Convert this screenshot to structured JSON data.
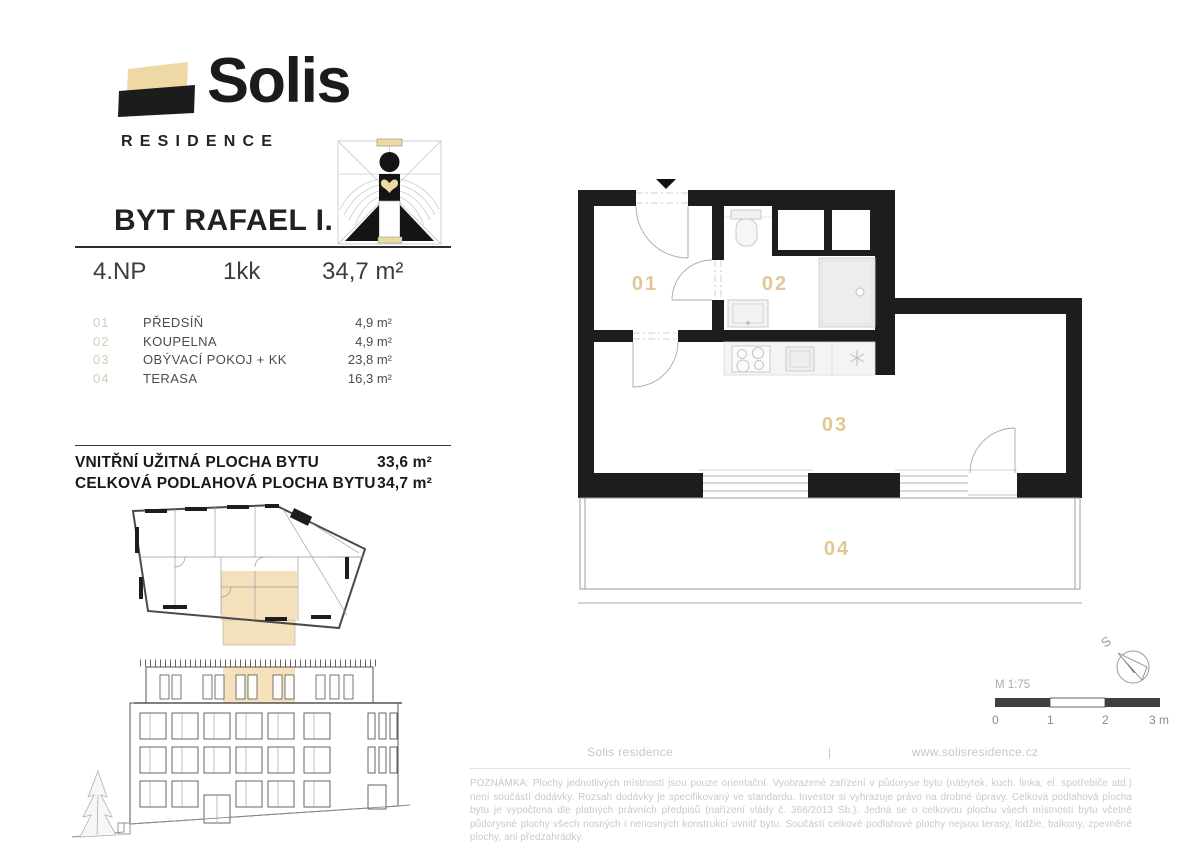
{
  "brand": {
    "name": "Solis",
    "subtitle": "RESIDENCE"
  },
  "unit": {
    "title": "BYT RAFAEL I.",
    "floor": "4.NP",
    "layout": "1kk",
    "area": "34,7 m²"
  },
  "rooms": [
    {
      "num": "01",
      "name": "PŘEDSÍŇ",
      "area": "4,9 m²"
    },
    {
      "num": "02",
      "name": "KOUPELNA",
      "area": "4,9 m²"
    },
    {
      "num": "03",
      "name": "OBÝVACÍ POKOJ + KK",
      "area": "23,8 m²"
    },
    {
      "num": "04",
      "name": "TERASA",
      "area": "16,3 m²"
    }
  ],
  "totals": [
    {
      "label": "VNITŘNÍ UŽITNÁ PLOCHA BYTU",
      "value": "33,6 m²"
    },
    {
      "label": "CELKOVÁ PODLAHOVÁ PLOCHA BYTU",
      "value": "34,7 m²"
    }
  ],
  "plan": {
    "labels": [
      "01",
      "02",
      "03",
      "04"
    ]
  },
  "scalebar": {
    "scale": "M 1:75",
    "ticks": [
      "0",
      "1",
      "2",
      "3 m"
    ],
    "compass": "S"
  },
  "footer": {
    "left": "Solis residence",
    "divider": "|",
    "right": "www.solisresidence.cz"
  },
  "note": "POZNÁMKA: Plochy jednotlivých místností jsou pouze orientační. Vyobrazené zařízení v půdoryse bytu (nábytek, kuch. linka, el. spotřebiče atd.) není součástí dodávky. Rozsah dodávky je specifikovaný ve standardu. Investor si vyhrazuje právo na drobné úpravy. Celková podlahová plocha bytu je vypočtena dle platných právních předpisů (nařízení vlády č. 366/2013 Sb.). Jedná se o celkovou plochu všech místností bytu včetně půdorysné plochy všech nosných i nenosných konstrukcí uvnitř bytu. Součástí celkové podlahové plochy nejsou terasy, lodžie, balkony, zpevněné plochy, ani předzahrádky.",
  "colors": {
    "accent_beige": "#eed9a4",
    "label_tan": "#e2c794",
    "wall_black": "#1d1d1d",
    "muted_gray": "#c9c9c9"
  }
}
